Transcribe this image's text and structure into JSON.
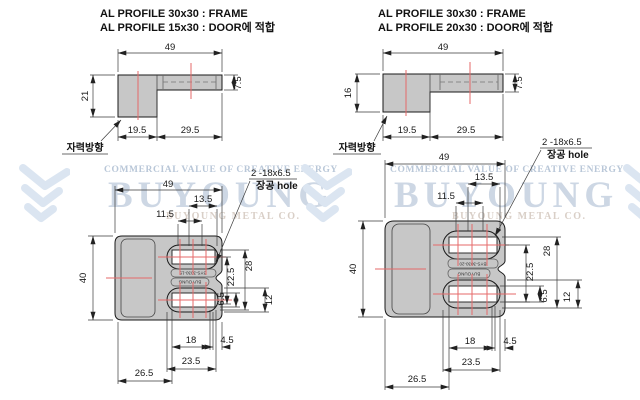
{
  "watermark": {
    "tagline": "COMMERCIAL VALUE OF CREATIVE ENERGY",
    "brand": "BUYOUNG",
    "company": "BUYOUNG METAL CO."
  },
  "left": {
    "title1": "AL PROFILE 30x30 : FRAME",
    "title2": "AL PROFILE 15x30 : DOOR에 적합",
    "side": {
      "w": "49",
      "h": "21",
      "lip": "7.5",
      "a": "19.5",
      "b": "29.5",
      "magnet": "자력방향"
    },
    "plan": {
      "w": "49",
      "d13": "13.5",
      "d11": "11.5",
      "h40": "40",
      "d22": "22.5",
      "d28": "28",
      "d6": "6.5",
      "d12": "12",
      "d18": "18",
      "d4": "4.5",
      "d23": "23.5",
      "d26": "26.5",
      "note1": "2 -18x6.5",
      "note2": "장공 hole",
      "model": "BYS-3030-15",
      "brand": "BUYOUNG"
    }
  },
  "right": {
    "title1": "AL PROFILE 30x30 : FRAME",
    "title2": "AL PROFILE 20x30 : DOOR에 적합",
    "side": {
      "w": "49",
      "h": "16",
      "lip": "7.5",
      "a": "19.5",
      "b": "29.5",
      "magnet": "자력방향"
    },
    "plan": {
      "w": "49",
      "d13": "13.5",
      "d11": "11.5",
      "h40": "40",
      "d22": "22.5",
      "d28": "28",
      "d6": "6.5",
      "d12": "12",
      "d18": "18",
      "d4": "4.5",
      "d23": "23.5",
      "d26": "26.5",
      "note1": "2 -18x6.5",
      "note2": "장공 hole",
      "model": "BYS-3030-20",
      "brand": "BUYOUNG"
    }
  },
  "colors": {
    "part_fill": "#c7c7c7",
    "centerline_red": "#e56a6a",
    "watermark_blue": "#cdd7e4"
  }
}
